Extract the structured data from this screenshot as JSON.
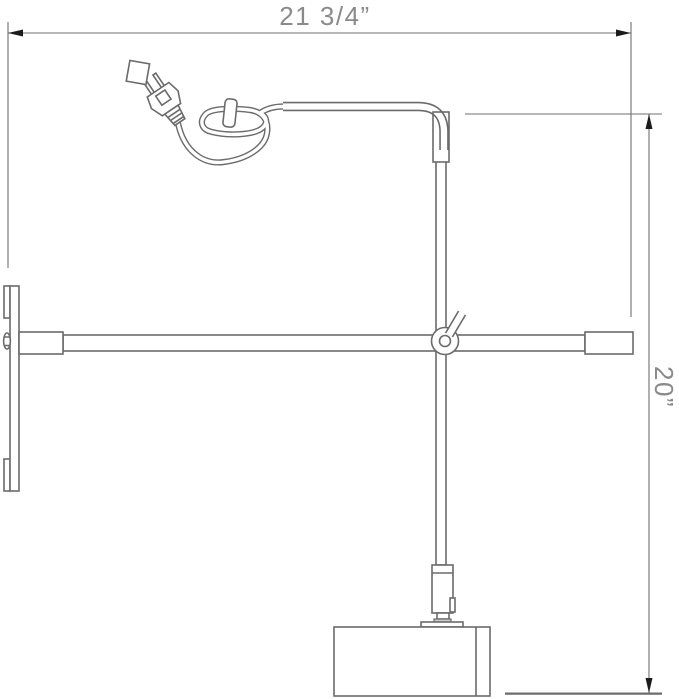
{
  "drawing": {
    "type": "technical line drawing",
    "subject": "wall-mount swing-arm picture lamp, side elevation with cord and plug",
    "dimension_width": {
      "value": "21 3/4”",
      "orientation": "horizontal",
      "position": "top"
    },
    "dimension_height": {
      "value": "20”",
      "orientation": "vertical",
      "position": "right"
    },
    "colors": {
      "background": "#ffffff",
      "line": "#6b6b6b",
      "dimension_line": "#6f6f6f",
      "arrowhead": "#1c1c1c",
      "text": "#8a8a8a",
      "collar_fill": "#c9c9c9"
    }
  }
}
